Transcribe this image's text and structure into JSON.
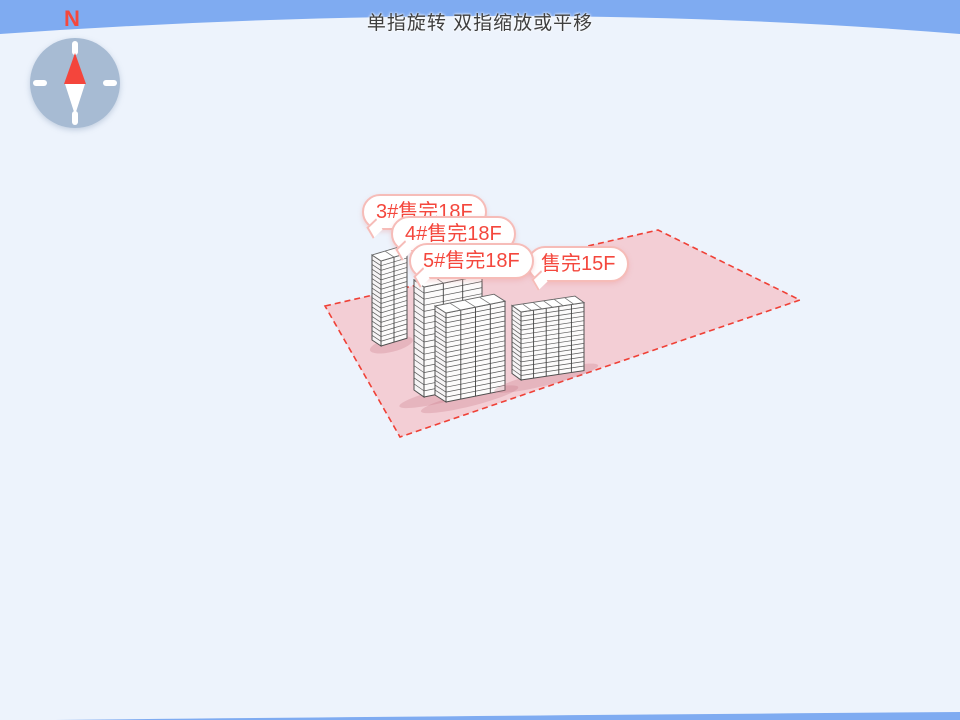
{
  "hint_text": "单指旋转 双指缩放或平移",
  "compass": {
    "north_label": "N"
  },
  "buildings": [
    {
      "label": "3#售完18F",
      "floors": 18,
      "status": "售完"
    },
    {
      "label": "4#售完18F",
      "floors": 18,
      "status": "售完"
    },
    {
      "label": "5#售完18F",
      "floors": 18,
      "status": "售完"
    },
    {
      "label": "售完15F",
      "floors": 15,
      "status": "售完"
    }
  ],
  "colors": {
    "sky": "#7fabf1",
    "ground": "#edf3fc",
    "plot_fill": "#f3ced5",
    "plot_border": "#ef4036",
    "label_red": "#f4473d",
    "bubble_border": "#f6bcb8",
    "building_line": "#4e4e4e",
    "compass_disc": "#a7bbd3",
    "needle_red": "#f4453c"
  }
}
